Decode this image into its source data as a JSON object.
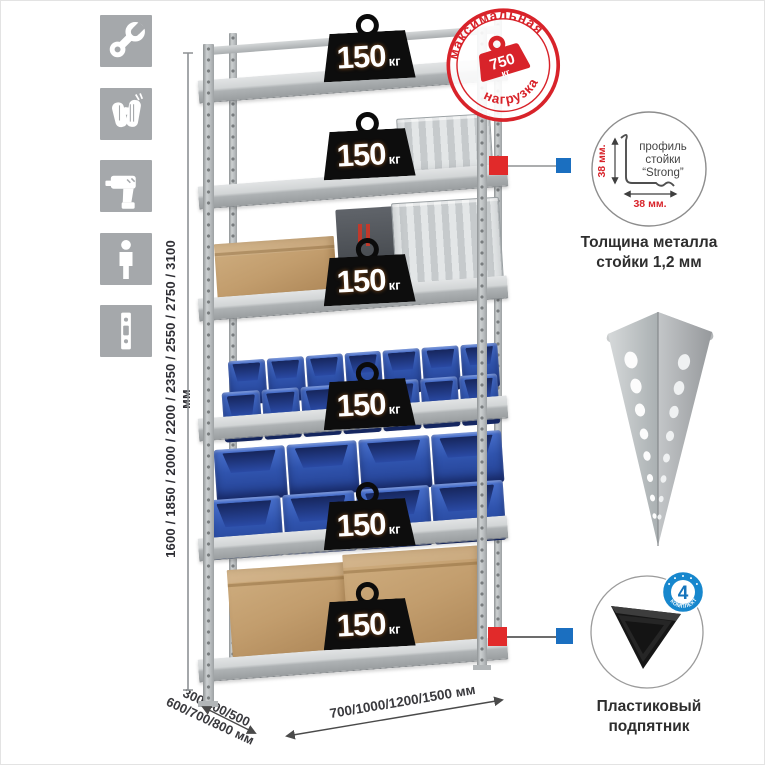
{
  "sidebar": {
    "icons": [
      {
        "name": "wrench"
      },
      {
        "name": "gloves"
      },
      {
        "name": "drill"
      },
      {
        "name": "person"
      },
      {
        "name": "perforated-post"
      }
    ]
  },
  "dimensions": {
    "height": "1600 / 1850 / 2000 / 2200 / 2350 / 2550 / 2750 / 3100 мм",
    "depth_line1": "300/400/500",
    "depth_line2": "600/700/800 мм",
    "width": "700/1000/1200/1500 мм"
  },
  "shelf_load": {
    "value": "150",
    "unit": "кг"
  },
  "max_load_stamp": {
    "arc_top": "максимальная",
    "arc_bottom": "нагрузка",
    "value": "750",
    "unit": "кг"
  },
  "profile_detail": {
    "line1": "профиль",
    "line2": "стойки",
    "line3": "“Strong”",
    "dim_v": "38 мм.",
    "dim_h": "38 мм.",
    "caption1": "Толщина металла",
    "caption2": "стойки 1,2 мм"
  },
  "foot_detail": {
    "badge_value": "4",
    "badge_arc": "в комплекте",
    "caption1": "Пластиковый",
    "caption2": "подпятник"
  },
  "colors": {
    "stamp_red": "#d8232a",
    "marker_red": "#e12a2a",
    "marker_blue": "#1b6fc0",
    "badge_blue": "#1787cd",
    "bin_blue": "#2f55b5",
    "metal_gray": "#b9bdbf"
  }
}
